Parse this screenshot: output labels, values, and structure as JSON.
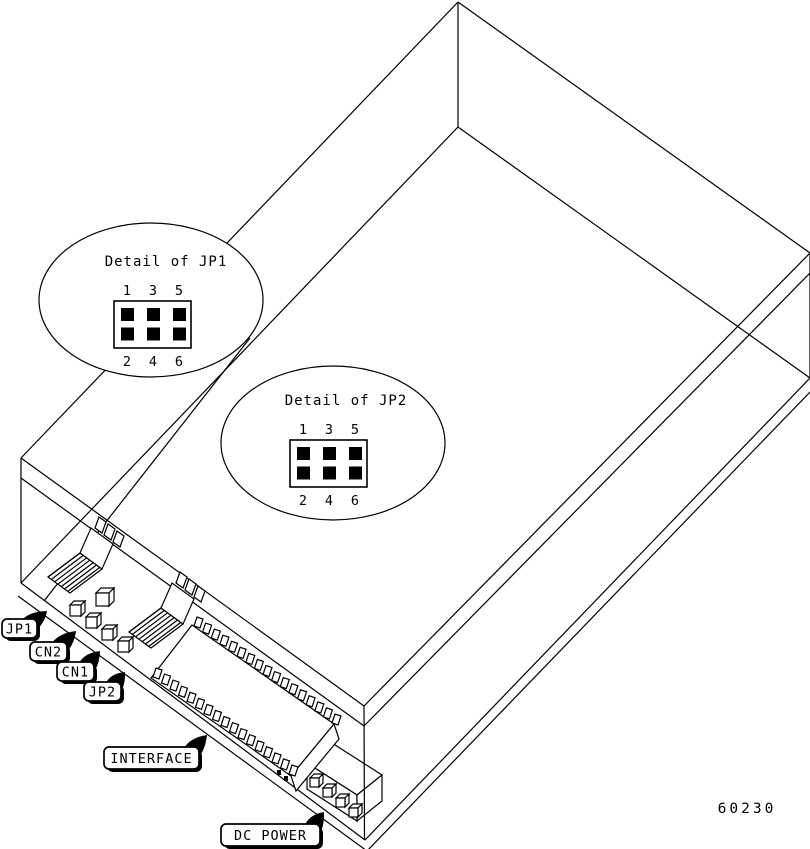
{
  "figure": {
    "type": "hardware-jumper-location-diagram",
    "part_number": "60230",
    "colors": {
      "line": "#000000",
      "background": "#ffffff"
    },
    "details": [
      {
        "title": "Detail of JP1",
        "pins_top": [
          "1",
          "3",
          "5"
        ],
        "pins_bottom": [
          "2",
          "4",
          "6"
        ],
        "pin_grid": {
          "rows": 2,
          "cols": 3,
          "filled": "all"
        }
      },
      {
        "title": "Detail of JP2",
        "pins_top": [
          "1",
          "3",
          "5"
        ],
        "pins_bottom": [
          "2",
          "4",
          "6"
        ],
        "pin_grid": {
          "rows": 2,
          "cols": 3,
          "filled": "all"
        }
      }
    ],
    "callouts": [
      {
        "label": "JP1"
      },
      {
        "label": "CN2"
      },
      {
        "label": "CN1"
      },
      {
        "label": "JP2"
      },
      {
        "label": "INTERFACE"
      },
      {
        "label": "DC POWER"
      }
    ]
  }
}
